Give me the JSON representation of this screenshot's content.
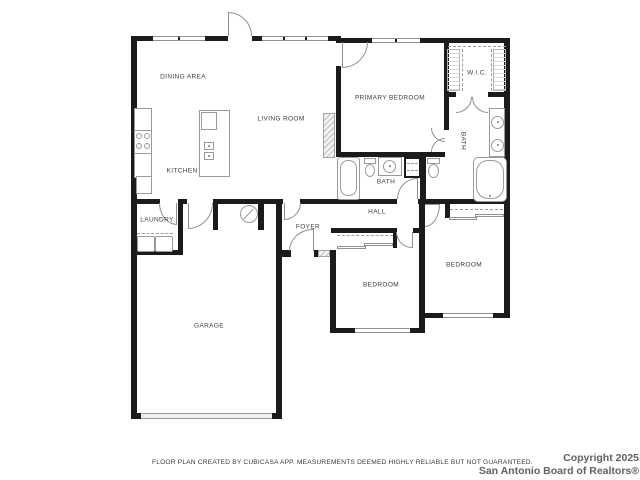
{
  "rooms": {
    "dining_area": "DINING AREA",
    "living_room": "LIVING ROOM",
    "kitchen": "KITCHEN",
    "laundry": "LAUNDRY",
    "foyer": "FOYER",
    "hall": "HALL",
    "hall_bath": "BATH",
    "primary_bedroom": "PRIMARY BEDROOM",
    "wic": "W.I.C.",
    "primary_bath": "BATH",
    "bedroom_bottom": "BEDROOM",
    "bedroom_right": "BEDROOM",
    "garage": "GARAGE"
  },
  "footer": {
    "disclaimer": "FLOOR PLAN CREATED BY CUBICASA APP. MEASUREMENTS DEEMED HIGHLY RELIABLE BUT NOT GUARANTEED.",
    "copyright_line1": "Copyright 2025",
    "copyright_line2": "San Antonio Board of Realtors®"
  },
  "colors": {
    "wall": "#1b1b1b",
    "fixture_stroke": "#9a9a9a",
    "label_text": "#3c3c3c",
    "footer_text": "#636363"
  }
}
